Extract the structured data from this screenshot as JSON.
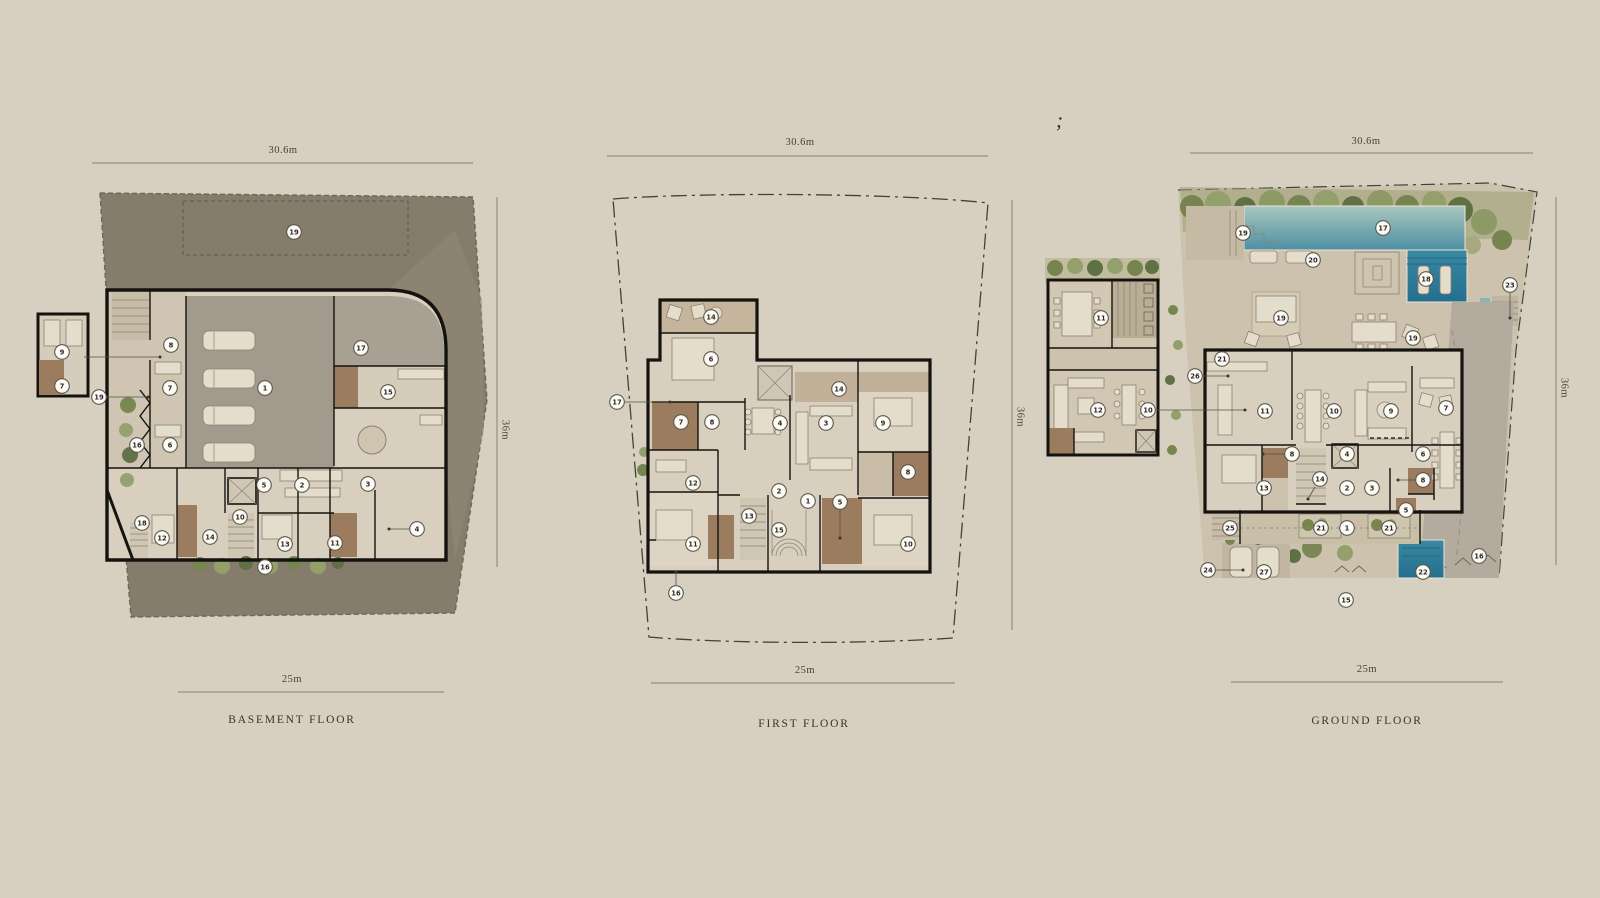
{
  "page": {
    "background": "#d7cfc0",
    "stray_mark": ";",
    "wall_color": "#15130f",
    "marker_fill": "#fcfbf6",
    "pool_color_top": "#a9c7bd",
    "pool_color_bottom": "#4e8fa3",
    "site_dark_color": "#867c6b",
    "floor_color": "#d8cfbf",
    "wet_room_color": "#9c7c5f",
    "green_color": "#76854f"
  },
  "floors": [
    {
      "id": "basement",
      "label": "BASEMENT FLOOR",
      "dim_top": "30.6m",
      "dim_bottom": "25m",
      "dim_side": "36m",
      "markers": [
        [
          19,
          294,
          232
        ],
        [
          9,
          62,
          352
        ],
        [
          7,
          62,
          386
        ],
        [
          19,
          99,
          397
        ],
        [
          8,
          171,
          345
        ],
        [
          7,
          170,
          388
        ],
        [
          1,
          265,
          388
        ],
        [
          17,
          361,
          348
        ],
        [
          15,
          388,
          392
        ],
        [
          16,
          137,
          445
        ],
        [
          6,
          170,
          445
        ],
        [
          5,
          264,
          485
        ],
        [
          2,
          302,
          485
        ],
        [
          3,
          368,
          484
        ],
        [
          18,
          142,
          523
        ],
        [
          12,
          162,
          538
        ],
        [
          14,
          210,
          537
        ],
        [
          10,
          240,
          517
        ],
        [
          13,
          285,
          544
        ],
        [
          11,
          335,
          543
        ],
        [
          4,
          417,
          529
        ],
        [
          16,
          265,
          567
        ]
      ],
      "leaders": [
        [
          107,
          397,
          148,
          397
        ],
        [
          84,
          357,
          160,
          357
        ],
        [
          409,
          529,
          389,
          529
        ]
      ]
    },
    {
      "id": "first",
      "label": "FIRST FLOOR",
      "dim_top": "30.6m",
      "dim_bottom": "25m",
      "dim_side": "36m",
      "markers": [
        [
          14,
          711,
          317
        ],
        [
          6,
          711,
          359
        ],
        [
          17,
          617,
          402
        ],
        [
          7,
          681,
          422
        ],
        [
          8,
          712,
          422
        ],
        [
          14,
          839,
          389
        ],
        [
          4,
          780,
          423
        ],
        [
          3,
          826,
          423
        ],
        [
          9,
          883,
          423
        ],
        [
          8,
          908,
          472
        ],
        [
          12,
          693,
          483
        ],
        [
          2,
          779,
          491
        ],
        [
          1,
          808,
          501
        ],
        [
          5,
          840,
          502
        ],
        [
          13,
          749,
          516
        ],
        [
          15,
          779,
          530
        ],
        [
          11,
          693,
          544
        ],
        [
          10,
          908,
          544
        ],
        [
          16,
          676,
          593
        ]
      ],
      "leaders": [
        [
          625,
          402,
          670,
          402
        ],
        [
          840,
          510,
          840,
          538
        ],
        [
          676,
          585,
          676,
          572
        ]
      ]
    },
    {
      "id": "ground",
      "label": "GROUND FLOOR",
      "dim_top": "30.6m",
      "dim_bottom": "25m",
      "dim_side": "36m",
      "markers": [
        [
          19,
          1243,
          233
        ],
        [
          17,
          1383,
          228
        ],
        [
          20,
          1313,
          260
        ],
        [
          18,
          1426,
          279
        ],
        [
          23,
          1510,
          285
        ],
        [
          19,
          1281,
          318
        ],
        [
          19,
          1413,
          338
        ],
        [
          11,
          1101,
          318
        ],
        [
          21,
          1222,
          359
        ],
        [
          26,
          1195,
          376
        ],
        [
          12,
          1098,
          410
        ],
        [
          10,
          1148,
          410
        ],
        [
          11,
          1265,
          411
        ],
        [
          10,
          1334,
          411
        ],
        [
          9,
          1391,
          411
        ],
        [
          7,
          1446,
          408
        ],
        [
          8,
          1292,
          454
        ],
        [
          4,
          1347,
          454
        ],
        [
          6,
          1423,
          454
        ],
        [
          8,
          1423,
          480
        ],
        [
          14,
          1320,
          479
        ],
        [
          13,
          1264,
          488
        ],
        [
          2,
          1347,
          488
        ],
        [
          3,
          1372,
          488
        ],
        [
          5,
          1406,
          510
        ],
        [
          25,
          1230,
          528
        ],
        [
          21,
          1321,
          528
        ],
        [
          1,
          1347,
          528
        ],
        [
          21,
          1389,
          528
        ],
        [
          16,
          1479,
          556
        ],
        [
          24,
          1208,
          570
        ],
        [
          27,
          1264,
          572
        ],
        [
          22,
          1423,
          572
        ],
        [
          15,
          1346,
          600
        ]
      ],
      "leaders": [
        [
          1510,
          293,
          1510,
          318
        ],
        [
          1203,
          376,
          1228,
          376
        ],
        [
          1157,
          410,
          1245,
          410
        ],
        [
          1216,
          570,
          1243,
          570
        ],
        [
          1284,
          454,
          1263,
          454
        ],
        [
          1415,
          480,
          1398,
          480
        ],
        [
          1315,
          487,
          1308,
          499
        ]
      ]
    }
  ]
}
